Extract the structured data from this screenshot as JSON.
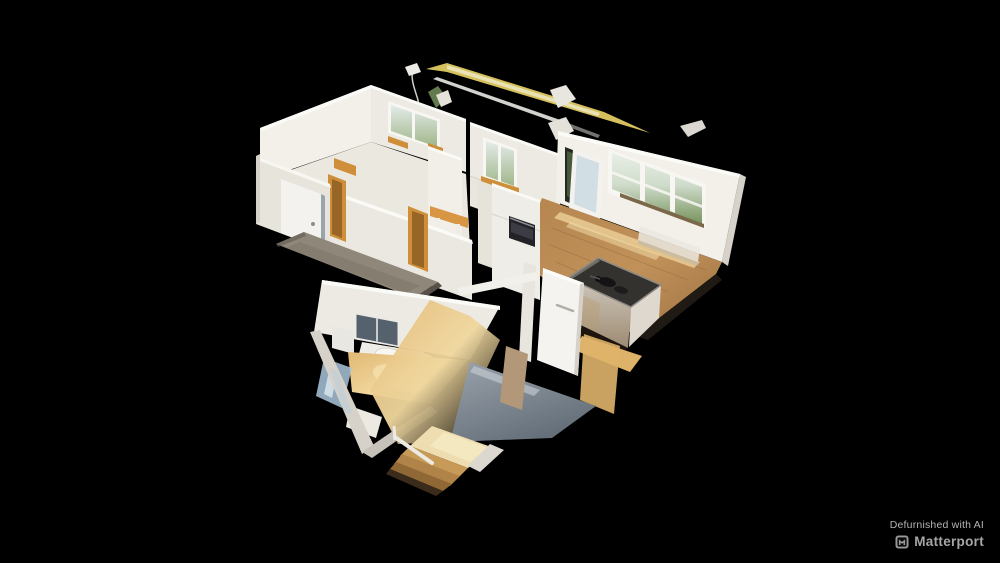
{
  "branding": {
    "caption": "Defurnished with AI",
    "brand": "Matterport",
    "logo_icon": "matterport-cube-logo"
  },
  "colors": {
    "background": "#000000",
    "caption_gray": "#b4b4b4",
    "brand_gray": "#a6a6a6",
    "logo_gray": "#9a9a9a",
    "wall_bright": "#f3f0ea",
    "wall_light": "#edeae3",
    "wall_mid": "#e7e4dc",
    "wall_shade": "#d6d2ca",
    "wall_top": "#fafaf6",
    "frame_white": "#f7f6f2",
    "glass_sky": "#e9efe7",
    "glass_green": "#76935c",
    "glass_blue": "#cddbe2",
    "wood_frame": "#cf8f3a",
    "floor_pale": "#ebe8df",
    "floor_gray": "#8f877a",
    "floor_slate": "#828c96",
    "wood_main": "#b5854f",
    "wood_sun": "#eed29a",
    "wood_bright": "#dfb26a",
    "bath_floor": "#e2b873",
    "cooktop": "#34322f",
    "oven": "#232327",
    "mirror": "#55616c",
    "shower_glass": "#a9c6da",
    "beam_yellow": "#d6c05e",
    "beam_white": "#d2d3cf",
    "island_face": "#cfc8bd",
    "door_tan": "#b29878",
    "stair_wood": "#c89a58"
  }
}
